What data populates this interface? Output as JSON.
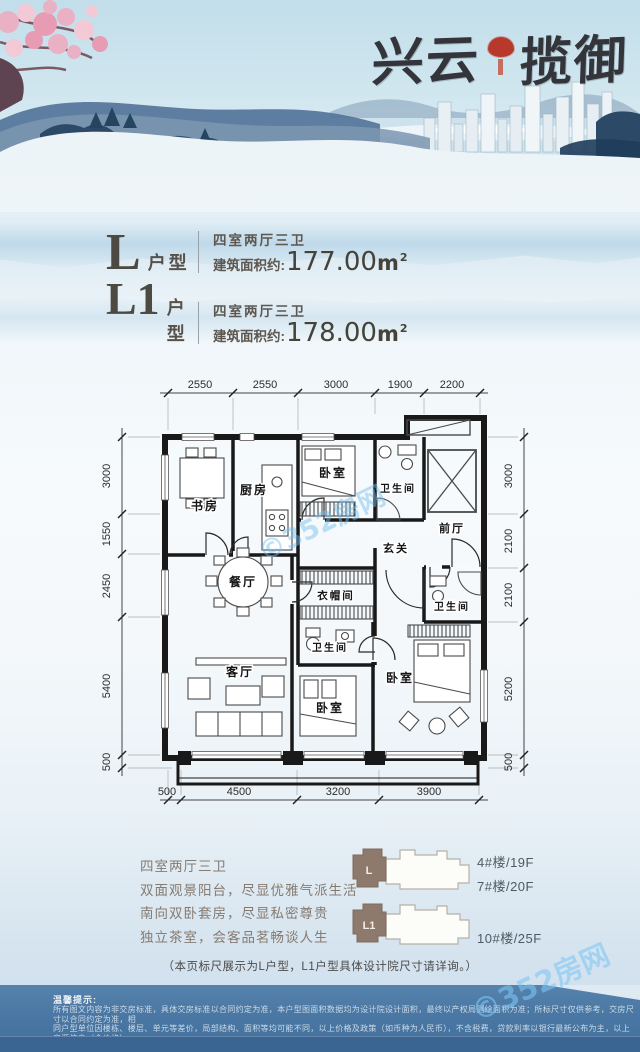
{
  "logo": {
    "name_left": "兴云",
    "name_right": "揽御"
  },
  "units": [
    {
      "code": "L",
      "type_suffix": "户型",
      "rooms": "四室两厅三卫",
      "area_prefix": "建筑面积约:",
      "area": "177.00",
      "unit": "m",
      "sup": "2"
    },
    {
      "code": "L1",
      "type_suffix": "户型",
      "rooms": "四室两厅三卫",
      "area_prefix": "建筑面积约:",
      "area": "178.00",
      "unit": "m",
      "sup": "2"
    }
  ],
  "plan": {
    "dims_top": [
      "2550",
      "2550",
      "3000",
      "1900",
      "2200"
    ],
    "dims_left": [
      "3000",
      "1550",
      "2450",
      "5400",
      "500"
    ],
    "dims_right": [
      "3000",
      "2100",
      "2100",
      "5200",
      "500"
    ],
    "dims_bottom": [
      "500",
      "4500",
      "3200",
      "3900"
    ],
    "rooms": {
      "study": "书房",
      "kitchen": "厨房",
      "bedroom_top": "卧室",
      "bath_top": "卫生间",
      "foyer": "前厅",
      "entry": "玄关",
      "dining": "餐厅",
      "cloakroom": "衣帽间",
      "bath_mid": "卫生间",
      "bath_right": "卫生间",
      "living": "客厅",
      "bedroom_mid": "卧室",
      "bedroom_right": "卧室"
    }
  },
  "features": [
    "四室两厅三卫",
    "双面观景阳台，尽显优雅气派生活",
    "南向双卧套房，尽显私密尊贵",
    "独立茶室，会客品茗畅谈人生"
  ],
  "buildings": [
    {
      "unit_label": "L",
      "floor_labels": [
        "4#楼/19F",
        "7#楼/20F"
      ]
    },
    {
      "unit_label": "L1",
      "floor_labels": [
        "10#楼/25F"
      ]
    }
  ],
  "note": "（本页标尺展示为L户型，L1户型具体设计院尺寸请详询。）",
  "disclaimer": {
    "title": "温馨提示:",
    "lines": [
      "所有图文内容为非交房标准，具体交房标准以合同约定为准，本户型图面积数据均为设计院设计面积，最终以产权局测绘面积为准；所标尺寸仅供参考，交房尺寸以合同约定为准，相",
      "同户型单位因楼栋、楼层、单元等差价，局部结构、面积等均可能不同，以上价格及政策（如币种为人民币），不含税费，贷款利率以银行最新公布为主，以上房源信息（含价格）",
      "仅供参考，本公司保留对价格进行调整的权利，具体房屋价格以双方签署的商品房买卖合同为准，如有变化，恕不另行通知。"
    ]
  },
  "watermark": "©352房网",
  "colors": {
    "accent_red": "#b8392c",
    "strip_blue": "#4a77a3",
    "highlight_taupe": "#8d7a6d"
  }
}
